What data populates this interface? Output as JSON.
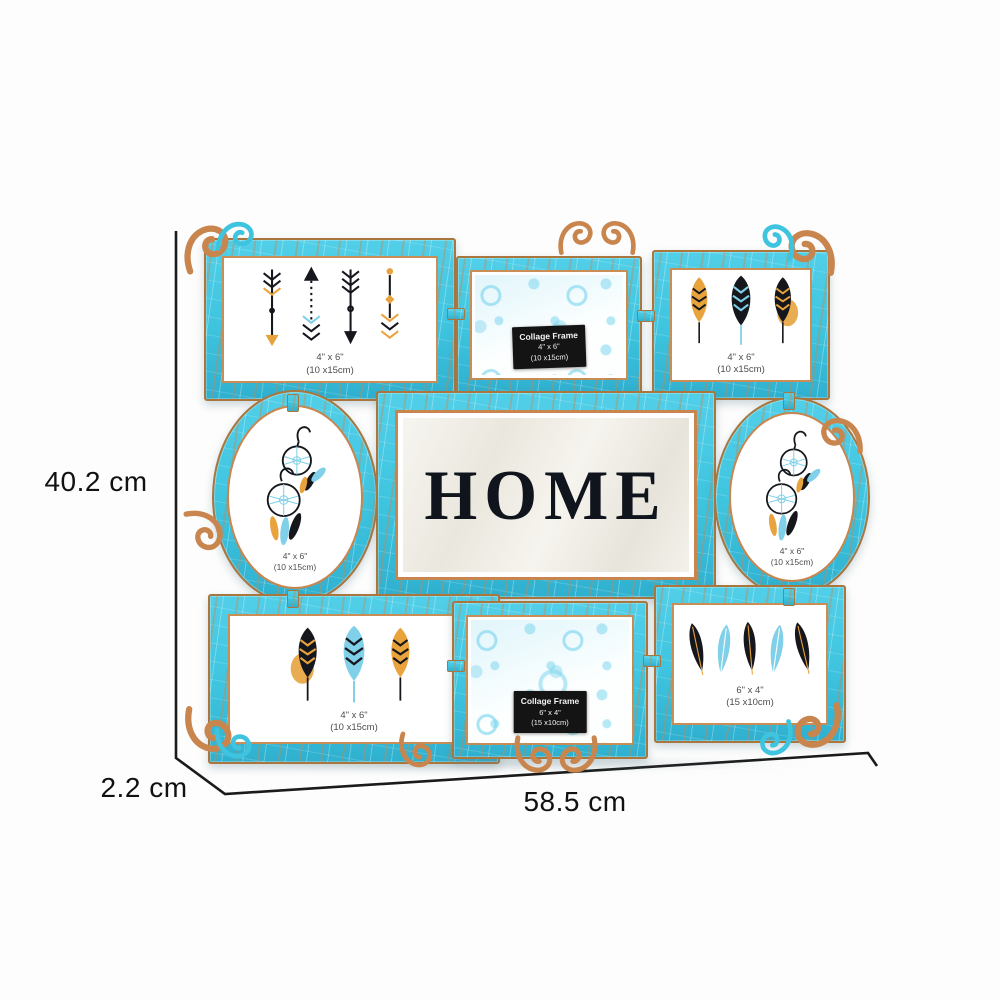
{
  "dimensions": {
    "height": "40.2 cm",
    "width": "58.5 cm",
    "depth": "2.2 cm"
  },
  "product": {
    "name": "distressed-turquoise-collage-photo-frame",
    "center_text": "HOME",
    "cells": {
      "top_left": {
        "art": "tribal-arrows",
        "caption_size": "4\" x 6\"",
        "caption_cm": "(10 x15cm)"
      },
      "top_center": {
        "art": "paisley-print",
        "plate": [
          "Collage Frame",
          "4\" x 6\"",
          "(10 x15cm)"
        ]
      },
      "top_right": {
        "art": "three-leaf-feathers",
        "caption_size": "4\" x 6\"",
        "caption_cm": "(10 x15cm)"
      },
      "middle_left": {
        "art": "dreamcatcher-earrings",
        "caption_size": "4\" x 6\"",
        "caption_cm": "(10 x15cm)"
      },
      "middle_center": {
        "art": "home-typography"
      },
      "middle_right": {
        "art": "dreamcatcher-earrings",
        "caption_size": "4\" x 6\"",
        "caption_cm": "(10 x15cm)"
      },
      "bottom_left": {
        "art": "three-leaf-feathers",
        "caption_size": "4\" x 6\"",
        "caption_cm": "(10 x15cm)"
      },
      "bottom_center": {
        "art": "paisley-print",
        "plate": [
          "Collage Frame",
          "6\" x 4\"",
          "(15 x10cm)"
        ]
      },
      "bottom_right": {
        "art": "five-feathers",
        "caption_size": "6\" x 4\"",
        "caption_cm": "(15 x10cm)"
      }
    }
  },
  "colors": {
    "frame_turquoise": "#3EC4DF",
    "frame_turquoise_dark": "#2FB0CF",
    "accent_copper": "#C9854E",
    "copper_dark": "#A9763E",
    "dimension_line": "#1B1B1B",
    "label_text": "#111111",
    "paisley_blue": "#7ED6EE",
    "artwork_gold": "#E8A33D",
    "artwork_black": "#15171D",
    "artwork_blue": "#7FD0E8",
    "home_text": "#10151D",
    "plate_bg": "#141414",
    "plate_text": "#F2F2F2",
    "caption_text": "#4D4D4D",
    "marble_ivory": "#F2EFE8"
  }
}
